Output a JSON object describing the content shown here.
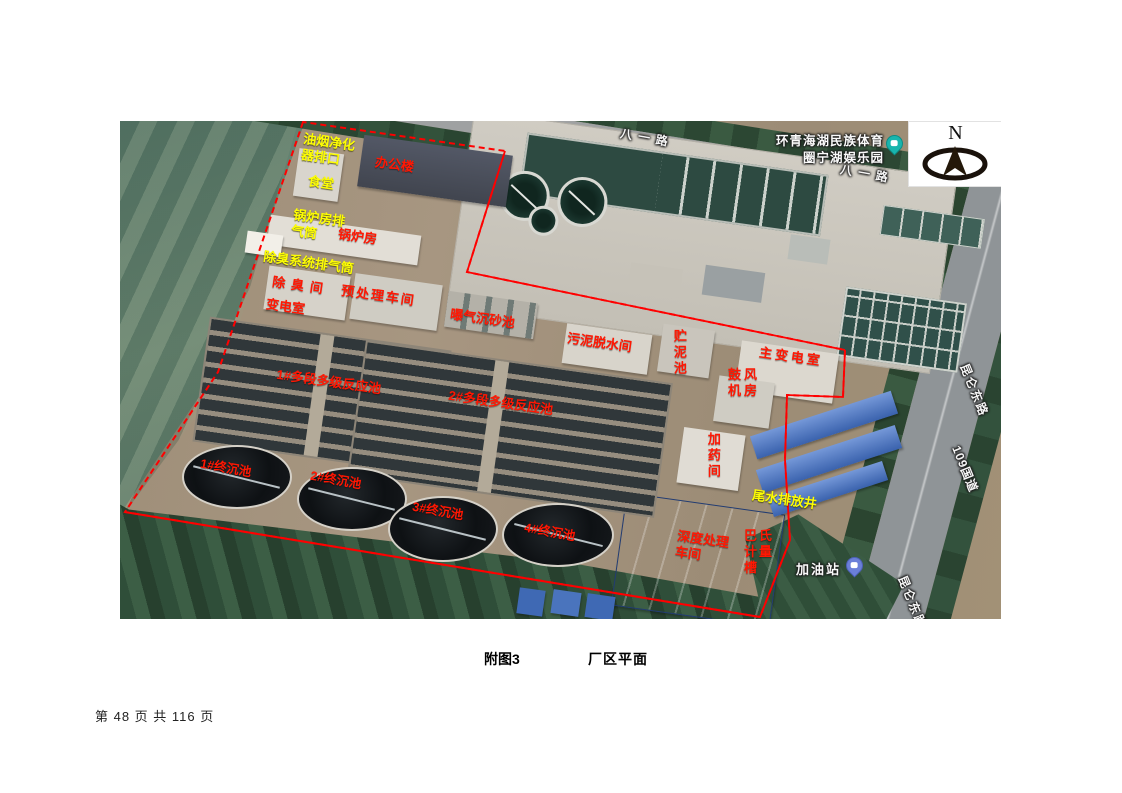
{
  "page": {
    "caption": {
      "figure_label": "附图3",
      "title": "厂区平面"
    },
    "footer": {
      "page_info": "第 48 页 共 116 页"
    }
  },
  "compass": {
    "letter": "N"
  },
  "map": {
    "accent_colors": {
      "boundary": "#ff0000",
      "label_red": "#ff1703",
      "label_yellow": "#fdfd04"
    },
    "roads": {
      "bayi_1": "八一路",
      "bayi_2": "八一路",
      "kunlun_east_1": "昆仑东路",
      "guodao_109": "109国道",
      "kunlun_east_2": "昆仑东路"
    },
    "pois": {
      "park_line1": "环青海湖民族体育",
      "park_line2": "圈宁湖娱乐园",
      "gas_station": "加油站"
    },
    "labels": [
      {
        "text": "油烟净化器排口",
        "color": "yellow"
      },
      {
        "text": "食堂",
        "color": "yellow"
      },
      {
        "text": "办公楼",
        "color": "red"
      },
      {
        "text": "锅炉房排气筒",
        "color": "yellow"
      },
      {
        "text": "锅炉房",
        "color": "red"
      },
      {
        "text": "除臭系统排气筒",
        "color": "yellow"
      },
      {
        "text": "除臭间",
        "color": "red"
      },
      {
        "text": "变电室",
        "color": "red"
      },
      {
        "text": "预处理车间",
        "color": "red"
      },
      {
        "text": "曝气沉砂池",
        "color": "red"
      },
      {
        "text": "1#多段多级反应池",
        "color": "red"
      },
      {
        "text": "2#多段多级反应池",
        "color": "red"
      },
      {
        "text": "1#终沉池",
        "color": "red"
      },
      {
        "text": "2#终沉池",
        "color": "red"
      },
      {
        "text": "3#终沉池",
        "color": "red"
      },
      {
        "text": "4#终沉池",
        "color": "red"
      },
      {
        "text": "污泥脱水间",
        "color": "red"
      },
      {
        "text": "贮泥池",
        "color": "red"
      },
      {
        "text": "主变电室",
        "color": "red"
      },
      {
        "text": "鼓风机房",
        "color": "red"
      },
      {
        "text": "加药间",
        "color": "red"
      },
      {
        "text": "尾水排放井",
        "color": "yellow"
      },
      {
        "text": "深度处理车间",
        "color": "red"
      },
      {
        "text": "巴氏计量槽",
        "color": "red"
      }
    ]
  }
}
